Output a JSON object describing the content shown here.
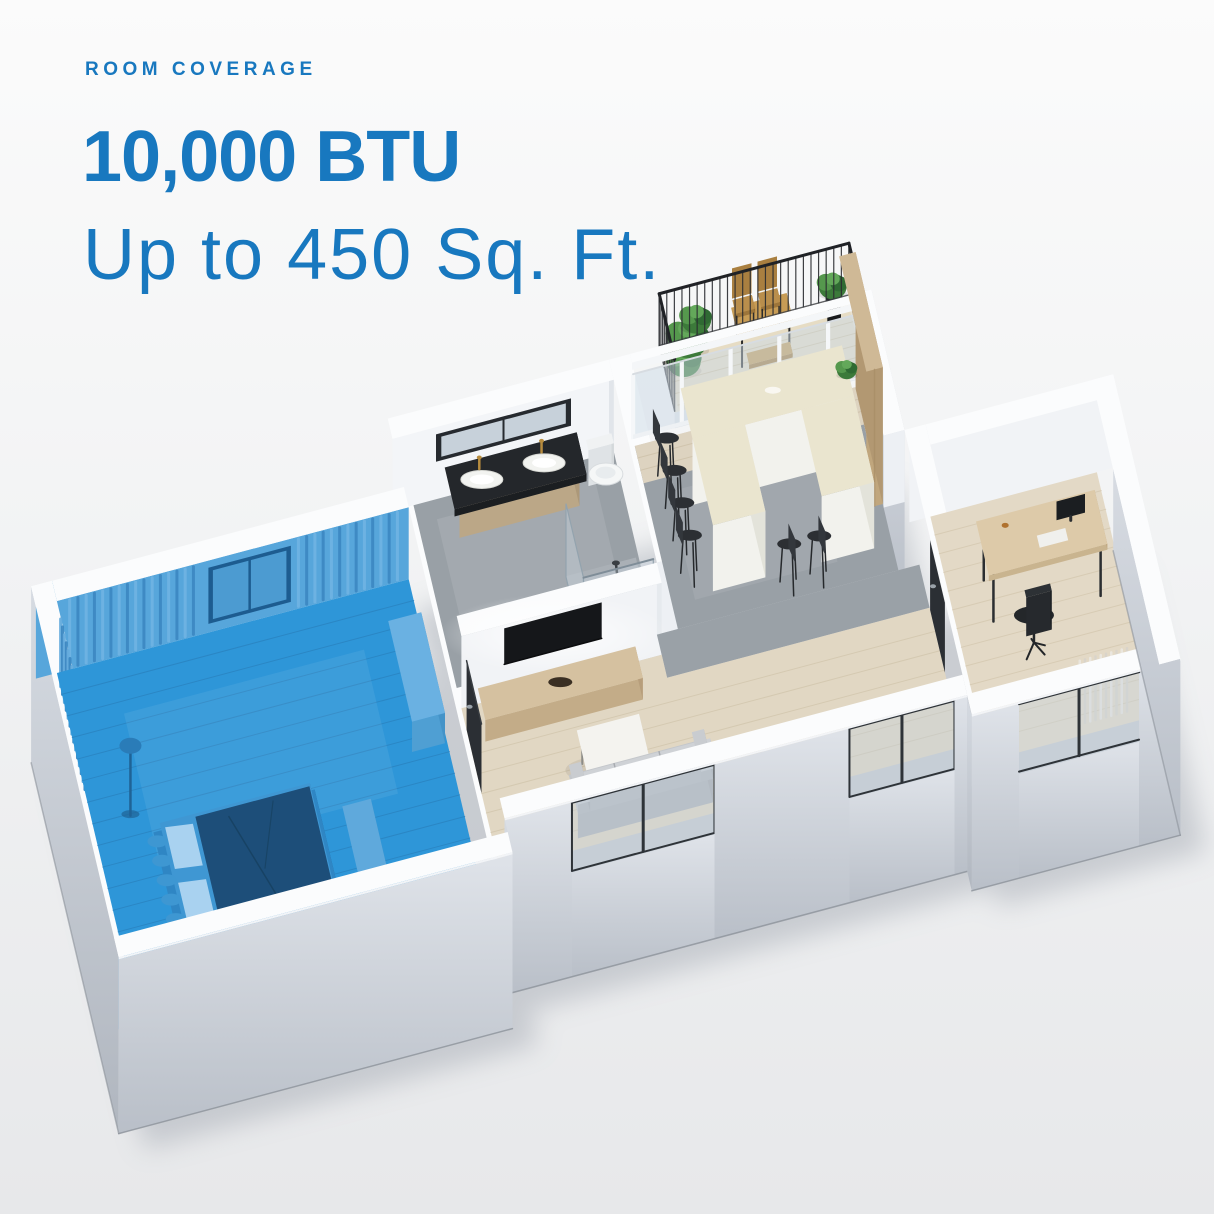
{
  "header": {
    "eyebrow": "ROOM COVERAGE",
    "title": "10,000 BTU",
    "subtitle": "Up to 450 Sq. Ft."
  },
  "colors": {
    "accent_blue": "#1878BF",
    "highlight_blue": "#2E96D8",
    "background_top": "#fbfbfb",
    "background_bottom": "#e7e8ea"
  },
  "floorplan": {
    "highlighted_room": "bedroom",
    "rooms": [
      "bedroom",
      "bathroom",
      "kitchen-dining",
      "living-room",
      "office",
      "balcony"
    ]
  }
}
